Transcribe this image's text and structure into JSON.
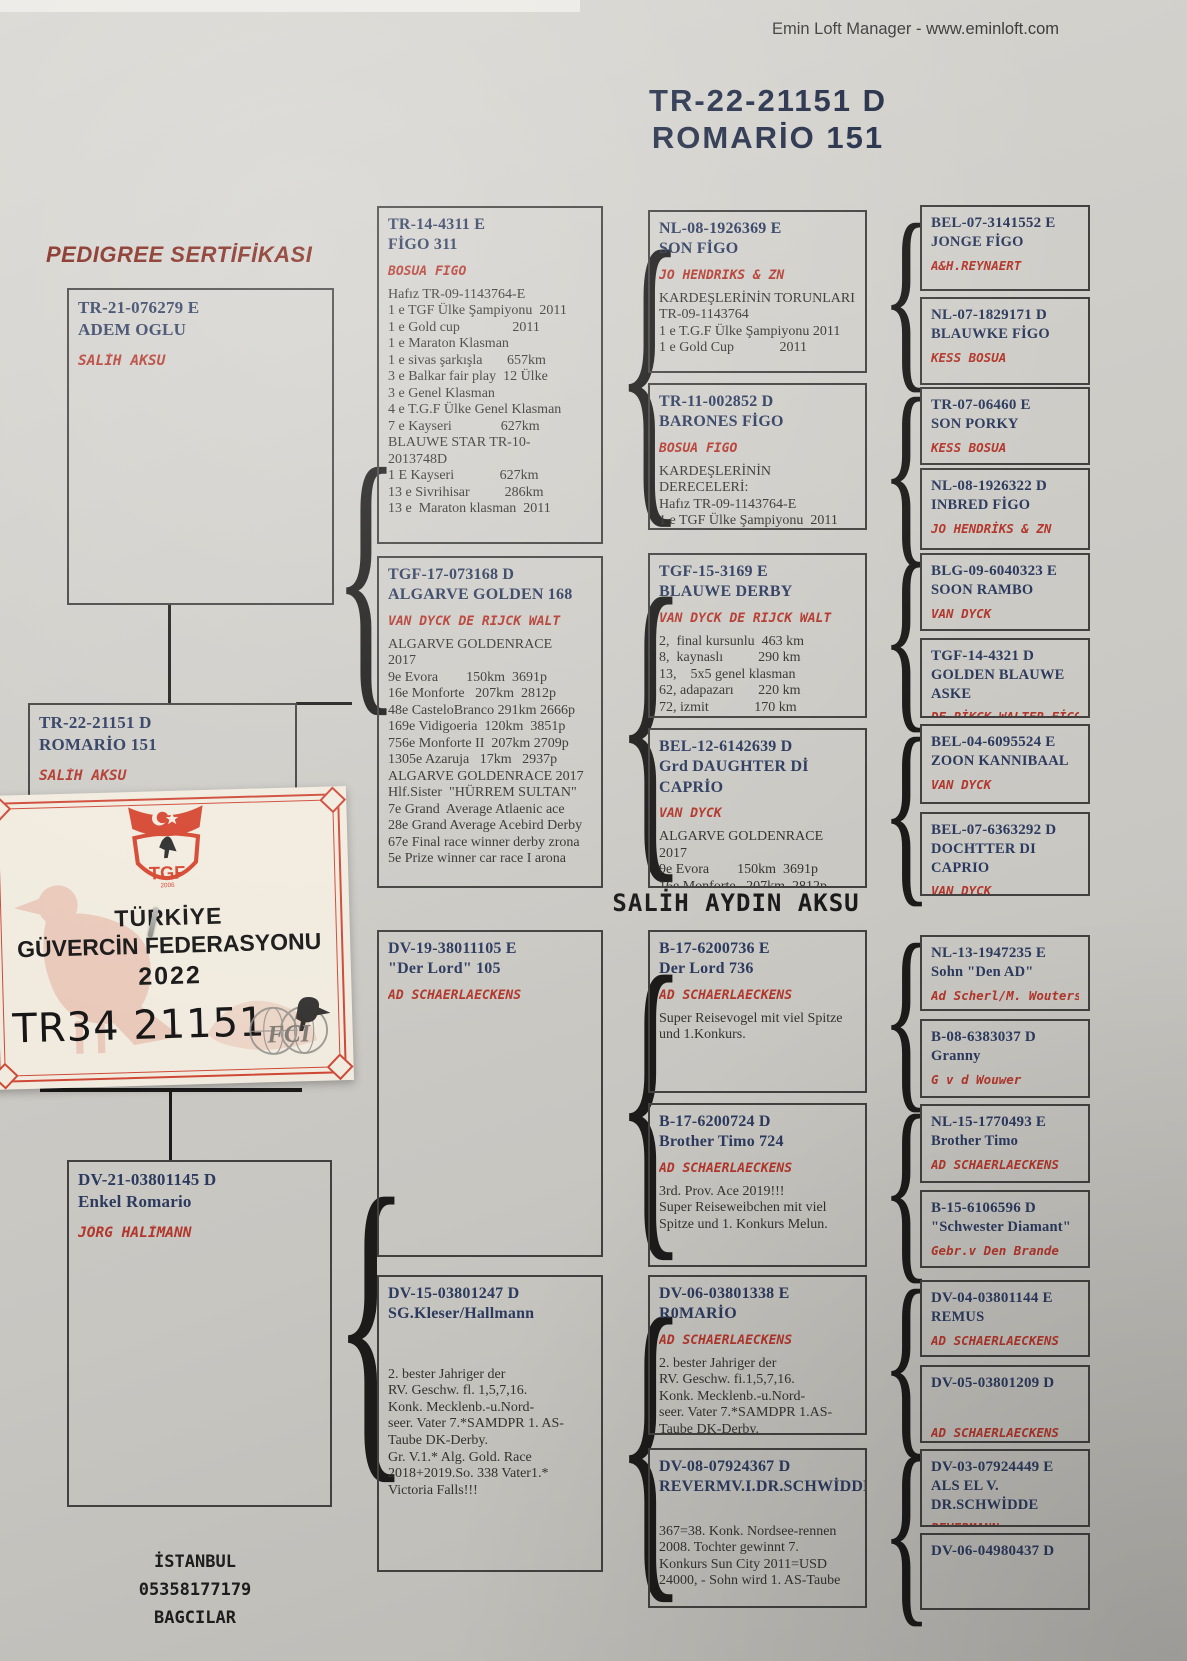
{
  "credit": "Emin Loft Manager - www.eminloft.com",
  "title": {
    "line1": "TR-22-21151   D",
    "line2": "ROMARİO  151"
  },
  "pedigree_label": "PEDIGREE SERTİFİKASI",
  "mid_heading": "SALİH AYDIN AKSU",
  "subject": {
    "id": "TR-22-21151  D",
    "name": "ROMARİO  151",
    "owner": "SALİH AKSU"
  },
  "gen1": [
    {
      "id": "TR-21-076279  E",
      "name": "ADEM   OGLU",
      "owner": "SALİH AKSU"
    },
    {
      "id": "DV-21-03801145  D",
      "name": "Enkel Romario",
      "owner": "JÖRG   HALİMANN"
    }
  ],
  "gen2": [
    {
      "id": "TR-14-4311  E",
      "name": "FİGO   311",
      "owner": "BOSUA     FİGO",
      "body": "Hafız TR-09-1143764-E\n1 e TGF Ülke Şampiyonu  2011\n1 e Gold cup               2011\n1 e Maraton Klasman\n1 e sivas şarkışla       657km\n3 e Balkar fair play  12 Ülke\n3 e Genel Klasman\n4 e T.G.F Ülke Genel Klasman\n7 e Kayseri              627km\nBLAUWE STAR TR-10-\n2013748D\n1 E Kayseri             627km\n13 e Sivrihisar          286km\n13 e  Maraton klasman  2011"
    },
    {
      "id": "TGF-17-073168  D",
      "name": "ALGARVE  GOLDEN 168",
      "owner": "VAN   DYCK  DE RİJCK WALT",
      "body": "ALGARVE GOLDENRACE\n2017\n9e Evora        150km  3691p\n16e Monforte   207km  2812p\n48e CasteloBranco 291km 2666p\n169e Vidigoeria  120km  3851p\n756e Monforte II  207km 2709p\n1305e Azaruja   17km   2937p\nALGARVE GOLDENRACE 2017\nHlf.Sister  \"HÜRREM SULTAN\"\n7e Grand  Average Atlaenic ace\n28e Grand Average Acebird Derby\n67e Final race winner derby zrona\n5e Prize winner car race I arona"
    },
    {
      "id": "DV-19-38011105  E",
      "name": "\"Der Lord\" 105",
      "owner": "AD  SCHAERLAECKENS",
      "body": ""
    },
    {
      "id": "DV-15-03801247  D",
      "name": "SG.Kleser/Hallmann",
      "owner": "",
      "body": "2. bester Jahriger der\nRV. Geschw. fl. 1,5,7,16.\nKonk. Mecklenb.-u.Nord-\nseer. Vater 7.*SAMDPR 1. AS-\nTaube DK-Derby.\nGr. V.1.* Alg. Gold. Race\n2018+2019.So. 338 Vater1.*\nVictoria Falls!!!"
    }
  ],
  "gen3": [
    {
      "id": "NL-08-1926369  E",
      "name": "SON FİGO",
      "owner": "JO HENDRİKS & ZN",
      "body": "KARDEŞLERİNİN TORUNLARI\nTR-09-1143764\n1 e T.G.F Ülke Şampiyonu 2011\n1 e Gold Cup             2011"
    },
    {
      "id": "TR-11-002852  D",
      "name": "BARONES FİGO",
      "owner": "BOSUA     FİGO",
      "body": "KARDEŞLERİNİN\nDERECELERİ:\nHafız TR-09-1143764-E\n1 e TGF Ülke Şampiyonu  2011"
    },
    {
      "id": "TGF-15-3169  E",
      "name": "BLAUWE DERBY",
      "owner": "VAN   DYCK  DE RİJCK WALT",
      "body": "2,  final kursunlu  463 km\n8,  kaynaslı          290 km\n13,    5x5 genel klasman\n62, adapazarı       220 km\n72, izmit             170 km"
    },
    {
      "id": "BEL-12-6142639  D",
      "name": "Grd DAUGHTER Dİ  CAPRİO",
      "owner": "VAN DYCK",
      "body": "ALGARVE GOLDENRACE  2017\n9e Evora        150km  3691p\n16e Monforte   207km  2812p\n48e CasteloBranco 291km 2666p\n169e Vidigoeria  120km  3851p"
    },
    {
      "id": "B-17-6200736  E",
      "name": "Der Lord 736",
      "owner": "AD  SCHAERLAECKENS",
      "body": "Super Reisevogel mit viel Spitze\nund 1.Konkurs."
    },
    {
      "id": "B-17-6200724  D",
      "name": "Brother Timo 724",
      "owner": "AD  SCHAERLAECKENS",
      "body": "3rd. Prov. Ace 2019!!!\nSuper Reiseweibchen mit viel\nSpitze und 1. Konkurs Melun."
    },
    {
      "id": "DV-06-03801338  E",
      "name": "R0MARİO",
      "owner": "AD  SCHAERLAECKENS",
      "body": "2. bester Jahriger der\nRV. Geschw. fi.1,5,7,16.\nKonk. Mecklenb.-u.Nord-\nseer. Vater 7.*SAMDPR 1.AS-\nTaube DK-Derby."
    },
    {
      "id": "DV-08-07924367  D",
      "name": "REVERMV.I.DR.SCHWİDDE",
      "owner": "",
      "body": "367=38. Konk. Nordsee-rennen\n2008. Tochter gewinnt 7.\nKonkurs Sun City 2011=USD\n24000, - Sohn wird 1. AS-Taube"
    }
  ],
  "gen4": [
    {
      "id": "BEL-07-3141552  E",
      "name": "JONGE FİGO",
      "owner": "A&H.REYNAERT"
    },
    {
      "id": "NL-07-1829171  D",
      "name": "BLAUWKE FİGO",
      "owner": "KESS BOSUA"
    },
    {
      "id": "TR-07-06460  E",
      "name": "SON PORKY",
      "owner": "KESS BOSUA"
    },
    {
      "id": "NL-08-1926322  D",
      "name": "INBRED FİGO",
      "owner": "JO HENDRİKS & ZN"
    },
    {
      "id": "BLG-09-6040323  E",
      "name": "SOON RAMBO",
      "owner": "VAN DYCK"
    },
    {
      "id": "TGF-14-4321  D",
      "name": "GOLDEN BLAUWE ASKE",
      "owner": "DE RİKCK WALTER  FİGO"
    },
    {
      "id": "BEL-04-6095524  E",
      "name": "ZOON  KANNIBAAL",
      "owner": "VAN DYCK"
    },
    {
      "id": "BEL-07-6363292  D",
      "name": "DOCHTTER DI CAPRIO",
      "owner": "VAN DYCK"
    },
    {
      "id": "NL-13-1947235  E",
      "name": "Sohn \"Den AD\"",
      "owner": "Ad Scherl/M. Wouters"
    },
    {
      "id": "B-08-6383037  D",
      "name": "Granny",
      "owner": "G v d Wouwer"
    },
    {
      "id": "NL-15-1770493  E",
      "name": "Brother Timo",
      "owner": "AD SCHAERLAECKENS"
    },
    {
      "id": "B-15-6106596  D",
      "name": "\"Schwester Diamant\"",
      "owner": "Gebr.v Den Brande"
    },
    {
      "id": "DV-04-03801144  E",
      "name": "REMUS",
      "owner": "AD SCHAERLAECKENS"
    },
    {
      "id": "DV-05-03801209  D",
      "name": "",
      "owner": "AD SCHAERLAECKENS"
    },
    {
      "id": "DV-03-07924449  E",
      "name": "ALS  EL V. DR.SCHWİDDE",
      "owner": "REVERMANN"
    },
    {
      "id": "DV-06-04980437  D",
      "name": "",
      "owner": ""
    }
  ],
  "sticker": {
    "federation_line1": "TÜRKİYE",
    "federation_line2": "GÜVERCİN FEDERASYONU",
    "year": "2022",
    "serial": "TR34 21151",
    "logo_text": "TGF",
    "logo_year": "2006",
    "emblem_text": "FCI"
  },
  "footer": [
    "İSTANBUL",
    "05358177179",
    "BAGCILAR"
  ],
  "colors": {
    "red_text": "#b2362b",
    "navy_text": "#2b3a5e",
    "stamp_red": "#cf4836",
    "paper": "#cdcbc6"
  }
}
